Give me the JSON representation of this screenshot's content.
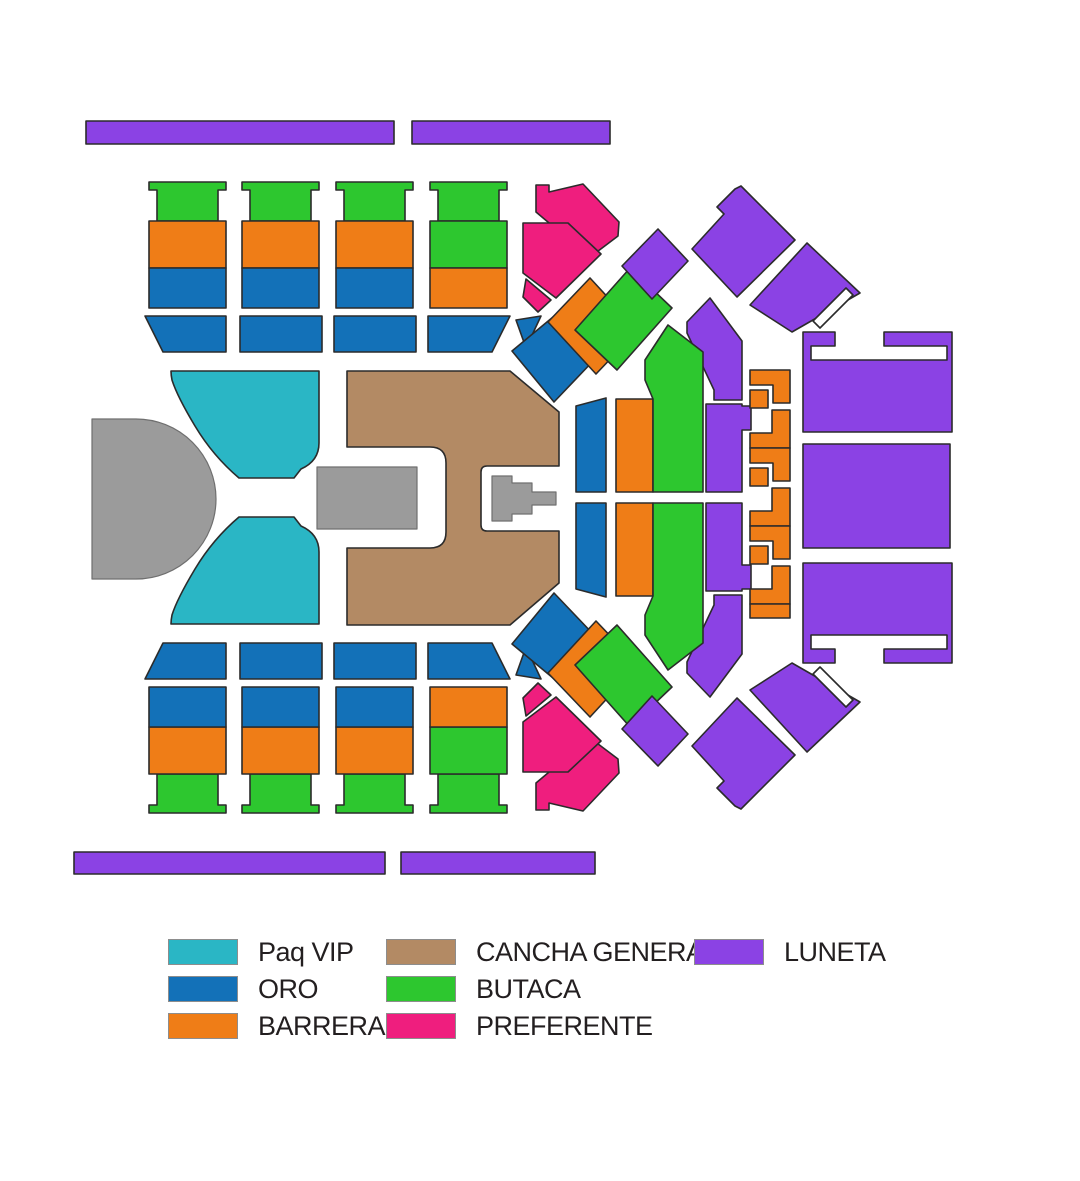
{
  "legend": {
    "items": [
      {
        "id": "paq-vip",
        "label": "Paq VIP",
        "color": "#2AB6C5"
      },
      {
        "id": "oro",
        "label": "ORO",
        "color": "#1371B8"
      },
      {
        "id": "barrera",
        "label": "BARRERA",
        "color": "#EF7D17"
      },
      {
        "id": "cancha-general",
        "label": "CANCHA GENERAL",
        "color": "#B38A64"
      },
      {
        "id": "butaca",
        "label": "BUTACA",
        "color": "#2DC72F"
      },
      {
        "id": "preferente",
        "label": "PREFERENTE",
        "color": "#EF1E7E"
      },
      {
        "id": "luneta",
        "label": "LUNETA",
        "color": "#8B42E4"
      }
    ],
    "text_color": "#231F20"
  },
  "map": {
    "background": "#FFFFFF",
    "outline_color": "#2B2B2B",
    "stage_color": "#9B9B9B",
    "stage_outline": "#6F6F6F"
  }
}
